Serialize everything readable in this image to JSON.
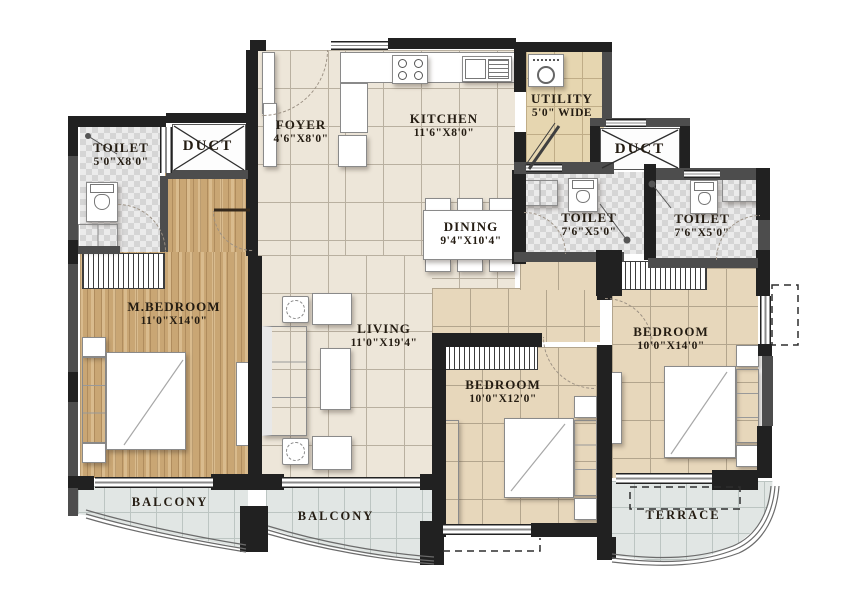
{
  "plan": {
    "rooms": {
      "toilet_left": {
        "name": "TOILET",
        "dims": "5'0\"X8'0\""
      },
      "duct_left": {
        "name": "DUCT"
      },
      "foyer": {
        "name": "FOYER",
        "dims": "4'6\"X8'0\""
      },
      "kitchen": {
        "name": "KITCHEN",
        "dims": "11'6\"X8'0\""
      },
      "utility": {
        "name": "UTILITY",
        "dims": "5'0\" WIDE"
      },
      "duct_right": {
        "name": "DUCT"
      },
      "toilet_mid": {
        "name": "TOILET",
        "dims": "7'6\"X5'0\""
      },
      "toilet_right": {
        "name": "TOILET",
        "dims": "7'6\"X5'0\""
      },
      "dining": {
        "name": "DINING",
        "dims": "9'4\"X10'4\""
      },
      "living": {
        "name": "LIVING",
        "dims": "11'0\"X19'4\""
      },
      "m_bedroom": {
        "name": "M.BEDROOM",
        "dims": "11'0\"X14'0\""
      },
      "bedroom_mid": {
        "name": "BEDROOM",
        "dims": "10'0\"X12'0\""
      },
      "bedroom_right": {
        "name": "BEDROOM",
        "dims": "10'0\"X14'0\""
      },
      "balcony_left": {
        "name": "BALCONY"
      },
      "balcony_mid": {
        "name": "BALCONY"
      },
      "terrace": {
        "name": "TERRACE"
      }
    },
    "colors": {
      "wall_dark": "#212121",
      "wall_gray": "#4d4d4d",
      "wood_floor": "#c9a674",
      "tile_cream": "#ede6d9",
      "tile_beige": "#e7d7bb",
      "tile_balcony": "#e1e6e4",
      "tile_utility": "#e6d6b0",
      "label_text": "#241c12"
    }
  }
}
